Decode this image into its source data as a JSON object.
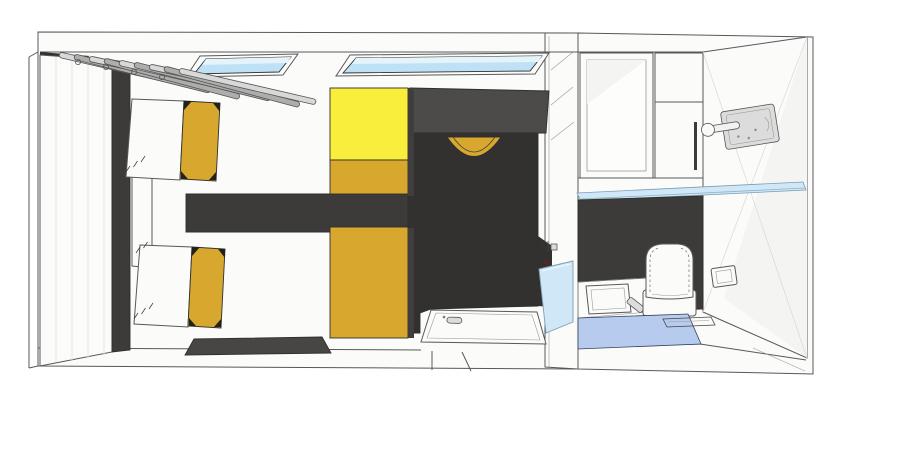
{
  "title": "3D top-down cutaway render of a twin room with en-suite bathroom",
  "colors": {
    "canvas": "#ffffff",
    "wall_white": "#fbfbfa",
    "panel_white": "#f3f2ef",
    "wall_shade": "#f4f4f2",
    "counter_white": "#f7f7f5",
    "tray_white": "#f4f4f2",
    "charcoal": "#3d3b3a",
    "charcoal_dark": "#333130",
    "block_gray": "#4c4b49",
    "rug_gray": "#474645",
    "edge_dark": "#3f3e3d",
    "bright_yellow": "#f9ee3c",
    "gold": "#d7a72e",
    "gold_shadow": "#a8821f",
    "skylight_glass": "#bfe1f5",
    "skylight_glass_light": "#e5f3fb",
    "glass_blue": "#cfe7f6",
    "mat_blue": "#b7cbee",
    "metal_light": "#dcdcdc",
    "hanger_light": "#d8d8d8",
    "hanger_mid": "#aeadac",
    "nightstand_gray": "#c9c7c4",
    "fixture_red": "#7c1622",
    "tick_dark": "#23221a"
  },
  "scene": {
    "rooms": [
      {
        "id": "bedroom",
        "label": "bedroom with twin beds and bunk"
      },
      {
        "id": "bathroom",
        "label": "en-suite bathroom"
      }
    ],
    "objects": [
      {
        "id": "skylight-left",
        "label": "skylight window"
      },
      {
        "id": "skylight-right",
        "label": "skylight window"
      },
      {
        "id": "clothes-hangers",
        "label": "clothes hangers on rail"
      },
      {
        "id": "wardrobe",
        "label": "wardrobe closet"
      },
      {
        "id": "bed-top",
        "label": "single bed with gold blanket"
      },
      {
        "id": "bed-bottom",
        "label": "single bed with gold blanket"
      },
      {
        "id": "nightstand",
        "label": "nightstand"
      },
      {
        "id": "bunk-upper",
        "label": "bunk bed, yellow bedding"
      },
      {
        "id": "bunk-lower",
        "label": "bunk bed, gold bedding"
      },
      {
        "id": "storage-block",
        "label": "gray storage cabinet"
      },
      {
        "id": "stool",
        "label": "round gold stool"
      },
      {
        "id": "dark-floor",
        "label": "dark floor area"
      },
      {
        "id": "rug",
        "label": "dark floor mat"
      },
      {
        "id": "shower-tray",
        "label": "shower tray with drain"
      },
      {
        "id": "shower-screen",
        "label": "glass shower screen"
      },
      {
        "id": "shower-valve",
        "label": "shower valve"
      },
      {
        "id": "bath-cabinet-left",
        "label": "bathroom open cabinet"
      },
      {
        "id": "bath-cabinet-right",
        "label": "bathroom cabinet with handle"
      },
      {
        "id": "door-handle",
        "label": "door handle plate"
      },
      {
        "id": "glass-shelf",
        "label": "glass shelf"
      },
      {
        "id": "backsplash",
        "label": "dark wall panel"
      },
      {
        "id": "toilet",
        "label": "toilet"
      },
      {
        "id": "flush-plate",
        "label": "flush plate"
      },
      {
        "id": "sink",
        "label": "sink basin"
      },
      {
        "id": "faucet",
        "label": "faucet"
      },
      {
        "id": "bath-mat",
        "label": "blue bath mat"
      },
      {
        "id": "floor-drain",
        "label": "floor drain slot"
      }
    ]
  }
}
